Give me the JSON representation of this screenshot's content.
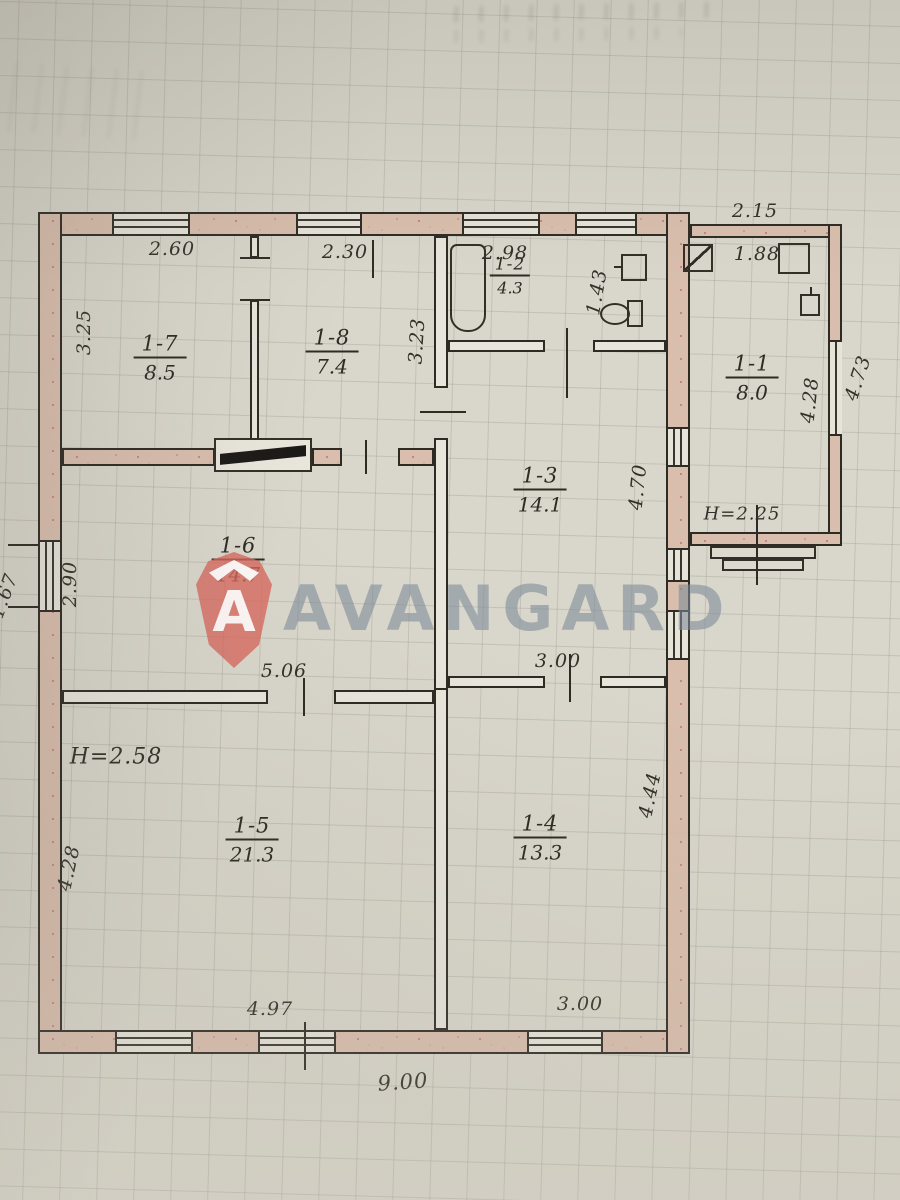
{
  "watermark": {
    "brand": "AVANGARD",
    "logo_letter": "A"
  },
  "rooms": [
    {
      "number": "1-7",
      "area": "8.5"
    },
    {
      "number": "1-8",
      "area": "7.4"
    },
    {
      "number": "1-2",
      "area": "4.3"
    },
    {
      "number": "1-1",
      "area": "8.0"
    },
    {
      "number": "1-3",
      "area": "14.1"
    },
    {
      "number": "1-6",
      "area": "14.7"
    },
    {
      "number": "1-5",
      "area": "21.3"
    },
    {
      "number": "1-4",
      "area": "13.3"
    }
  ],
  "dims": {
    "top_1_7": "2.60",
    "top_1_8": "2.30",
    "top_1_2": "2.98",
    "right_1_2": "1.43",
    "annex_top": "2.15",
    "annex_inner_top": "1.88",
    "left_1_7": "3.25",
    "right_1_8": "3.23",
    "annex_right_inner": "4.28",
    "annex_right_outer": "4.73",
    "right_1_3": "4.70",
    "annex_height": "H=2.25",
    "left_1_6": "2.90",
    "bottom_1_6": "5.06",
    "bottom_1_3": "3.00",
    "main_height": "H=2.58",
    "left_1_5": "4.28",
    "right_1_4": "4.44",
    "bottom_1_5": "4.97",
    "bottom_1_4": "3.00",
    "bottom_total": "9.00",
    "left_total": "11.67"
  },
  "colors": {
    "paper": "#d9d6cb",
    "ink": "#2e2a24",
    "wall_fill": "#d9bead",
    "logo_red": "#d7675c",
    "watermark_gray": "#7c8a98"
  }
}
